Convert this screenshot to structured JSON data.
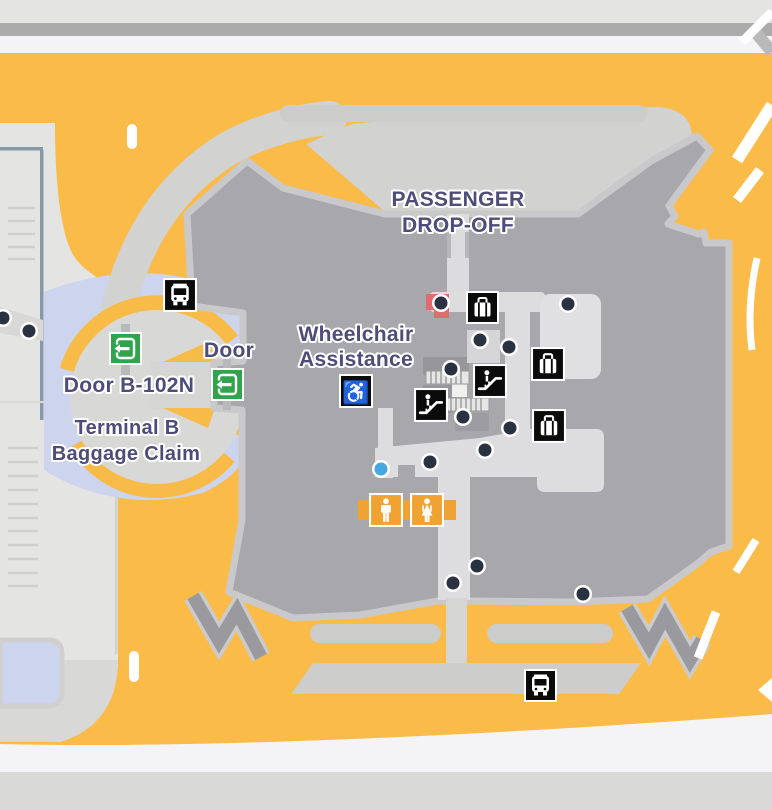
{
  "map": {
    "title": "Terminal B ground transportation map",
    "labels": {
      "passenger_dropoff": {
        "line1": "PASSENGER",
        "line2": "DROP-OFF"
      },
      "wheelchair_assistance": {
        "line1": "Wheelchair",
        "line2": "Assistance"
      },
      "door": "Door",
      "door_b102n": "Door B-102N",
      "terminal_b_baggage_claim": {
        "line1": "Terminal B",
        "line2": "Baggage Claim"
      }
    },
    "icons": {
      "bus": {
        "name": "bus-stop",
        "count": 2
      },
      "baggage": {
        "name": "baggage-claim",
        "count": 3
      },
      "escalator": {
        "name": "escalator",
        "count": 2
      },
      "wheelchair": {
        "name": "wheelchair-assistance",
        "glyph": "♿"
      },
      "restroom_men": {
        "name": "restroom-men",
        "count": 1
      },
      "restroom_women": {
        "name": "restroom-women",
        "count": 1
      },
      "exit_door": {
        "name": "exit-door",
        "count": 2
      }
    },
    "poi_dots": {
      "dark": [
        [
          3,
          318
        ],
        [
          29,
          331
        ],
        [
          441,
          303
        ],
        [
          568,
          304
        ],
        [
          480,
          340
        ],
        [
          509,
          347
        ],
        [
          451,
          369
        ],
        [
          463,
          417
        ],
        [
          510,
          428
        ],
        [
          485,
          450
        ],
        [
          430,
          462
        ],
        [
          477,
          566
        ],
        [
          453,
          583
        ],
        [
          583,
          594
        ]
      ],
      "blue": [
        [
          381,
          469
        ]
      ]
    },
    "colors": {
      "roadway_yellow": "#fbbb49",
      "curb_gray": "#d2d2d0",
      "terminal_gray": "#a8a8ac",
      "terminal_outline": "#c9c9cb",
      "walkway_gray": "#dddddf",
      "lavender": "#cdd4ee",
      "label_purple": "#4e4c78",
      "door_green": "#2fa44d",
      "restroom_orange": "#f0a233",
      "icon_black": "#0b0b0b",
      "dot_navy": "#2a3140",
      "dot_blue": "#47a7de",
      "red_area": "#e26b70",
      "parking_gray": "#e4e4e2",
      "divider_gray": "#ababab"
    }
  }
}
